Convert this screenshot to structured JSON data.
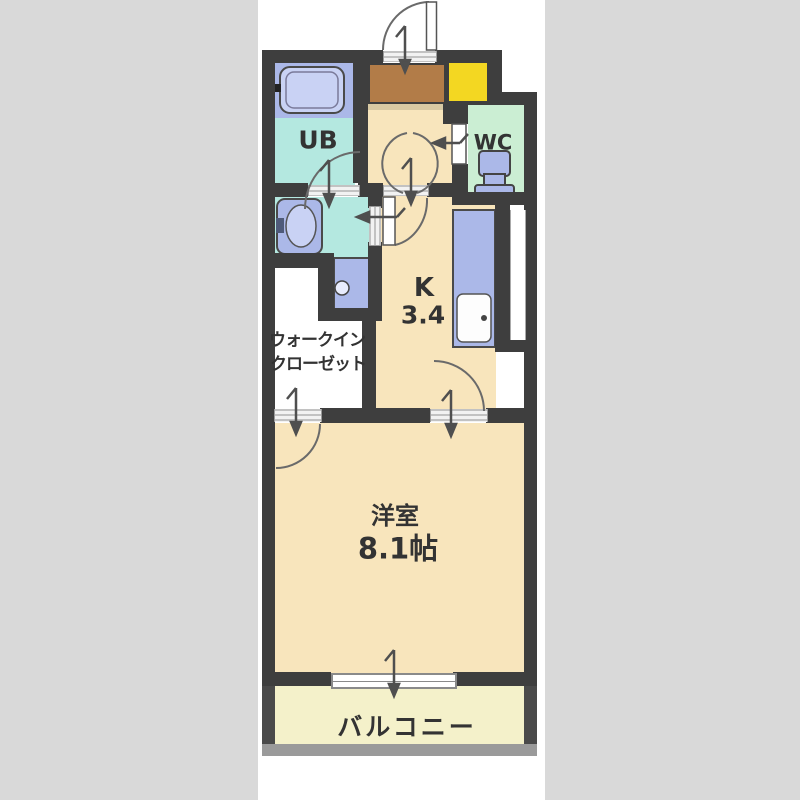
{
  "title": "1K apartment floor plan",
  "colors": {
    "page_bg": "#d9d9d9",
    "panel": "#ffffff",
    "wall": "#3e3e3e",
    "floor_beige": "#f8e5bc",
    "wet_cyan": "#b4e8e0",
    "wc_mint": "#cbeed3",
    "fixture_periwinkle": "#abb8e8",
    "fixture_light": "#c9d2f4",
    "genkan_brown": "#b27c48",
    "step_tan": "#d8c9a3",
    "shoe_yellow": "#f3d722",
    "balcony_yellow": "#f4f1ca"
  },
  "rooms": {
    "unit_bath": {
      "label": "UB"
    },
    "toilet_room": {
      "label": "WC"
    },
    "kitchen": {
      "label": "K",
      "size": "3.4"
    },
    "walk_in_closet": {
      "line1": "ウォークイン",
      "line2": "クローゼット"
    },
    "western_room": {
      "label": "洋室",
      "size": "8.1帖"
    },
    "balcony": {
      "label": "バルコニー"
    }
  },
  "fixtures": [
    "bathtub",
    "bath-tap",
    "washbasin",
    "washing-machine-pan",
    "toilet",
    "kitchen-counter",
    "kitchen-sink",
    "shoe-cabinet",
    "entrance-door",
    "wc-door",
    "kitchen-door",
    "sliding-window"
  ]
}
